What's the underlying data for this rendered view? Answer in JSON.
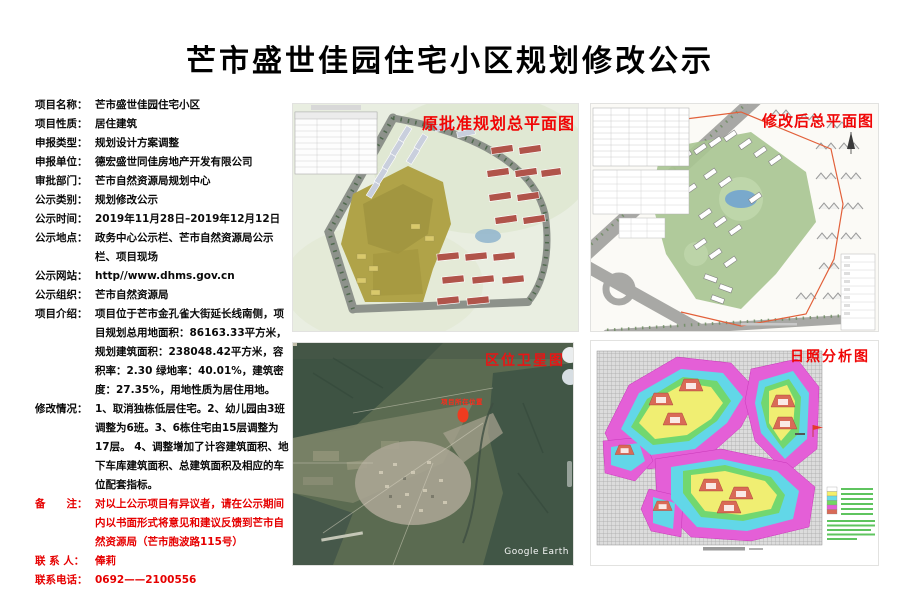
{
  "page": {
    "title": "芒市盛世佳园住宅小区规划修改公示"
  },
  "info": {
    "fields": [
      {
        "label": "项目名称：",
        "value": "芒市盛世佳园住宅小区",
        "red": false
      },
      {
        "label": "项目性质：",
        "value": "居住建筑",
        "red": false
      },
      {
        "label": "申报类型：",
        "value": "规划设计方案调整",
        "red": false
      },
      {
        "label": "申报单位：",
        "value": "德宏盛世同佳房地产开发有限公司",
        "red": false
      },
      {
        "label": "审批部门：",
        "value": "芒市自然资源局规划中心",
        "red": false
      },
      {
        "label": "公示类别：",
        "value": "规划修改公示",
        "red": false
      },
      {
        "label": "公示时间：",
        "value": "2019年11月28日–2019年12月12日",
        "red": false
      },
      {
        "label": "公示地点：",
        "value": "政务中心公示栏、芒市自然资源局公示栏、项目现场",
        "red": false
      },
      {
        "label": "公示网站：",
        "value": "http//www.dhms.gov.cn",
        "red": false
      },
      {
        "label": "公示组织：",
        "value": "芒市自然资源局",
        "red": false
      },
      {
        "label": "项目介绍：",
        "value": "项目位于芒市金孔雀大街延长线南侧，项目规划总用地面积：86163.33平方米， 规划建筑面积：238048.42平方米，容积率：2.30 绿地率：40.01%，建筑密度：27.35%，用地性质为居住用地。",
        "red": false
      },
      {
        "label": "修改情况：",
        "value": "1、取消独栋低层住宅。2、幼儿园由3班 调整为6班。3、6栋住宅由15层调整为17层。 4、调整增加了计容建筑面积、地下车库建筑面积、总建筑面积及相应的车位配套指标。",
        "red": false
      },
      {
        "label": "备　　注：",
        "value": "对以上公示项目有异议者，请在公示期间内以书面形式将意见和建议反馈到芒市自然资源局（芒市胞波路115号）",
        "red": true
      },
      {
        "label": "联 系 人：",
        "value": "俸莉",
        "red": true
      },
      {
        "label": "联系电话：",
        "value": "0692——2100556",
        "red": true
      }
    ]
  },
  "panels": {
    "original_plan": {
      "label": "原批准规划总平面图"
    },
    "modified_plan": {
      "label": "修改后总平面图"
    },
    "satellite": {
      "label": "区位卫星图",
      "marker_text": "项目所在位置",
      "watermark": "Google Earth"
    },
    "sunshine": {
      "label": "日照分析图"
    }
  },
  "colors": {
    "red_text": "#e60000",
    "panel_label_red": "#f00606"
  }
}
